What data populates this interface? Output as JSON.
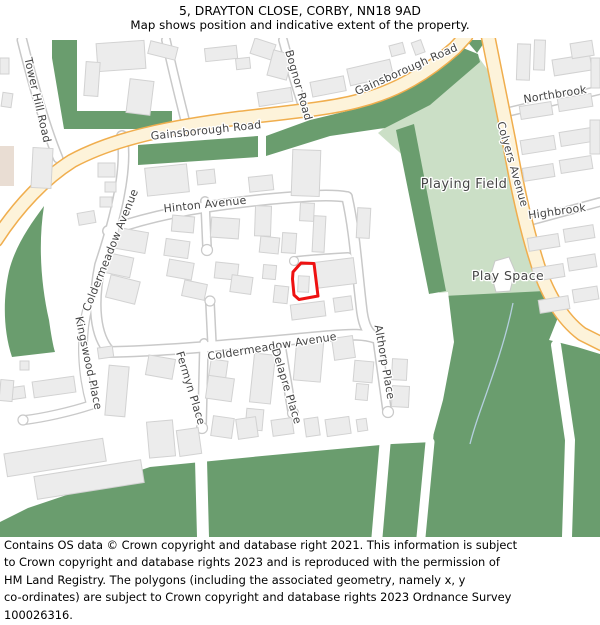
{
  "title": {
    "line1": "5, DRAYTON CLOSE, CORBY, NN18 9AD",
    "line2": "Map shows position and indicative extent of the property."
  },
  "map": {
    "labels": {
      "tower_hill": "Tower Hill Road",
      "gainsborough_1": "Gainsborough Road",
      "gainsborough_2": "Gainsborough Road",
      "bognor": "Bognor Road",
      "northbrook": "Northbrook",
      "colyers": "Colyers Avenue",
      "highbrook": "Highbrook",
      "playing_field": "Playing Field",
      "play_space": "Play Space",
      "hinton": "Hinton Avenue",
      "coldermeadow_west": "Coldermeadow Avenue",
      "coldermeadow_south": "Coldermeadow Avenue",
      "kingswood": "Kingswood Place",
      "fermyn": "Fermyn Place",
      "delapre": "Delapre Place",
      "althorp": "Althorp Place"
    },
    "colors": {
      "green_dark": "#6a9d6e",
      "green_light": "#cbdfc6",
      "road_major_fill": "#fdf3da",
      "road_major_casing": "#f0ae4e",
      "road_minor_casing": "#c9c9c9",
      "building_fill": "#ececec",
      "beige_fill": "#e9ddd3",
      "property_outline": "#ee1111",
      "label_color": "#454545",
      "stream": "#b5cfdf"
    }
  },
  "footer": {
    "lines": [
      "Contains OS data © Crown copyright and database right 2021. This information is subject",
      "to Crown copyright and database rights 2023 and is reproduced with the permission of",
      "HM Land Registry. The polygons (including the associated geometry, namely x, y",
      "co-ordinates) are subject to Crown copyright and database rights 2023 Ordnance Survey",
      "100026316."
    ]
  }
}
